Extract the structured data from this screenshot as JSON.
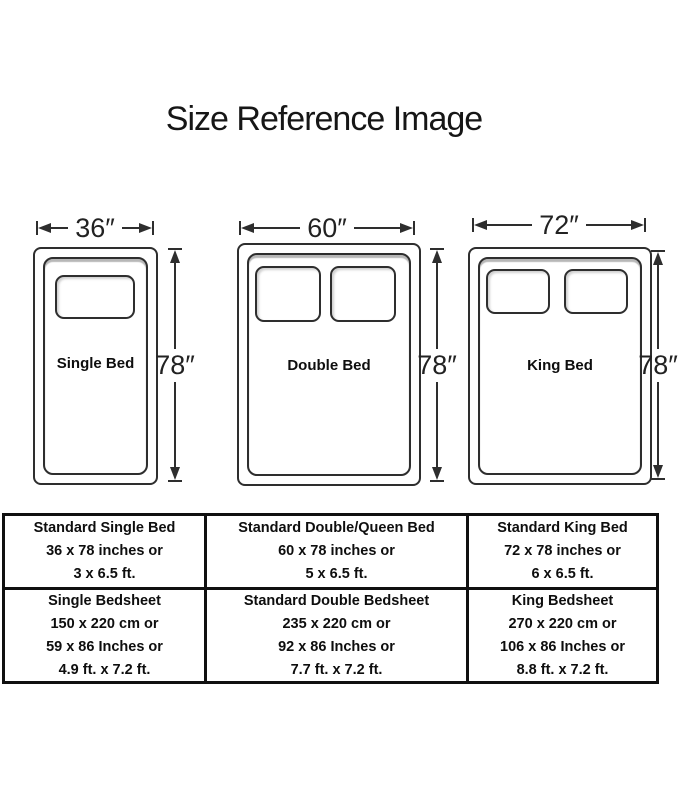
{
  "title": "Size Reference Image",
  "colors": {
    "line": "#2e2e2e",
    "text": "#111111",
    "table_border": "#101010"
  },
  "figures": [
    {
      "name": "Single Bed",
      "width_label": "36″",
      "height_label": "78″",
      "pillows": 1
    },
    {
      "name": "Double Bed",
      "width_label": "60″",
      "height_label": "78″",
      "pillows": 2
    },
    {
      "name": "King Bed",
      "width_label": "72″",
      "height_label": "78″",
      "pillows": 2
    }
  ],
  "table": {
    "rows": [
      [
        {
          "lines": [
            "Standard Single Bed",
            "36 x 78 inches or",
            "3 x 6.5 ft."
          ]
        },
        {
          "lines": [
            "Standard Double/Queen Bed",
            "60 x 78 inches or",
            "5 x 6.5 ft."
          ]
        },
        {
          "lines": [
            "Standard King Bed",
            "72 x 78 inches or",
            "6 x 6.5 ft."
          ]
        }
      ],
      [
        {
          "lines": [
            "Single Bedsheet",
            "150 x 220 cm or",
            "59 x 86 Inches or",
            "4.9 ft. x 7.2 ft."
          ]
        },
        {
          "lines": [
            "Standard Double Bedsheet",
            "235 x 220 cm or",
            "92 x 86 Inches or",
            "7.7 ft. x 7.2 ft."
          ]
        },
        {
          "lines": [
            "King Bedsheet",
            "270 x 220 cm or",
            "106 x 86 Inches or",
            "8.8 ft. x 7.2 ft."
          ]
        }
      ]
    ]
  }
}
